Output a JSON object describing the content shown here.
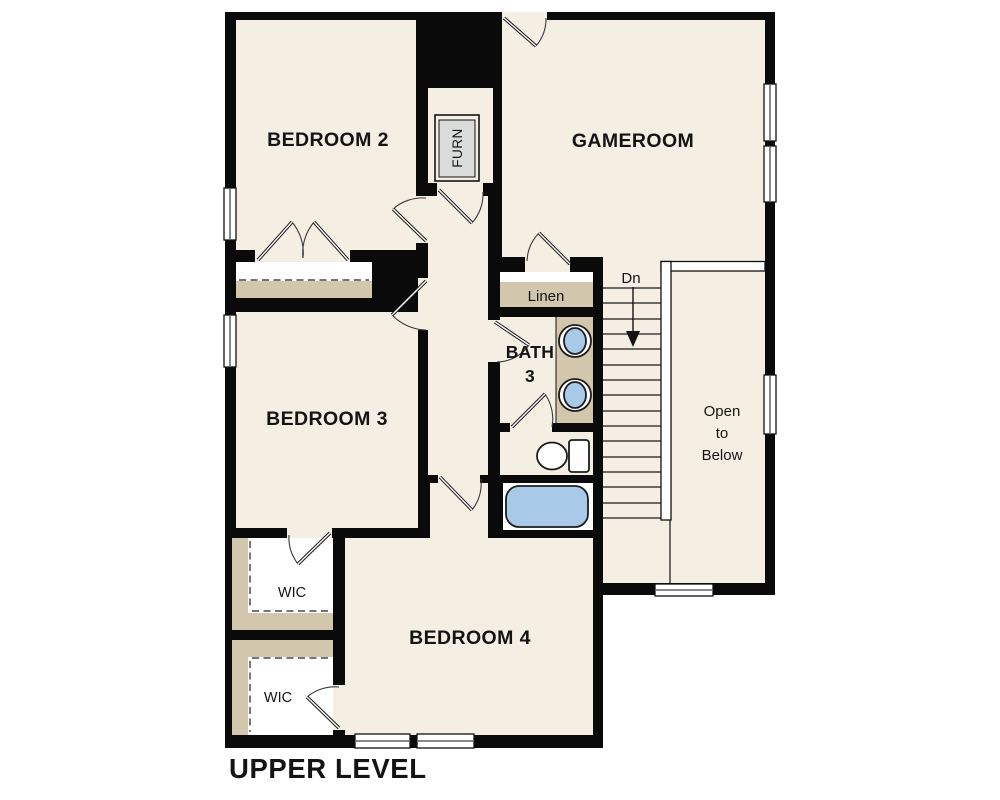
{
  "floor_plan": {
    "title": "UPPER LEVEL",
    "rooms": {
      "bedroom2": {
        "label": "BEDROOM 2"
      },
      "gameroom": {
        "label": "GAMEROOM"
      },
      "bedroom3": {
        "label": "BEDROOM 3"
      },
      "bedroom4": {
        "label": "BEDROOM 4"
      },
      "bath3": {
        "line1": "BATH",
        "line2": "3"
      },
      "linen": {
        "label": "Linen"
      },
      "wic_upper": {
        "label": "WIC"
      },
      "wic_lower": {
        "label": "WIC"
      },
      "open_to_below": {
        "line1": "Open",
        "line2": "to",
        "line3": "Below"
      },
      "furnace_closet": {
        "label": "FURN"
      }
    },
    "stairs": {
      "direction_label": "Dn"
    },
    "colors": {
      "background": "#ffffff",
      "floor": "#f5eee2",
      "wall": "#0a0a0a",
      "closet_shelf_tan": "#d2c7ac",
      "fixture_blue": "#a9c9e8",
      "furnace_gray": "#d9dcda"
    }
  }
}
